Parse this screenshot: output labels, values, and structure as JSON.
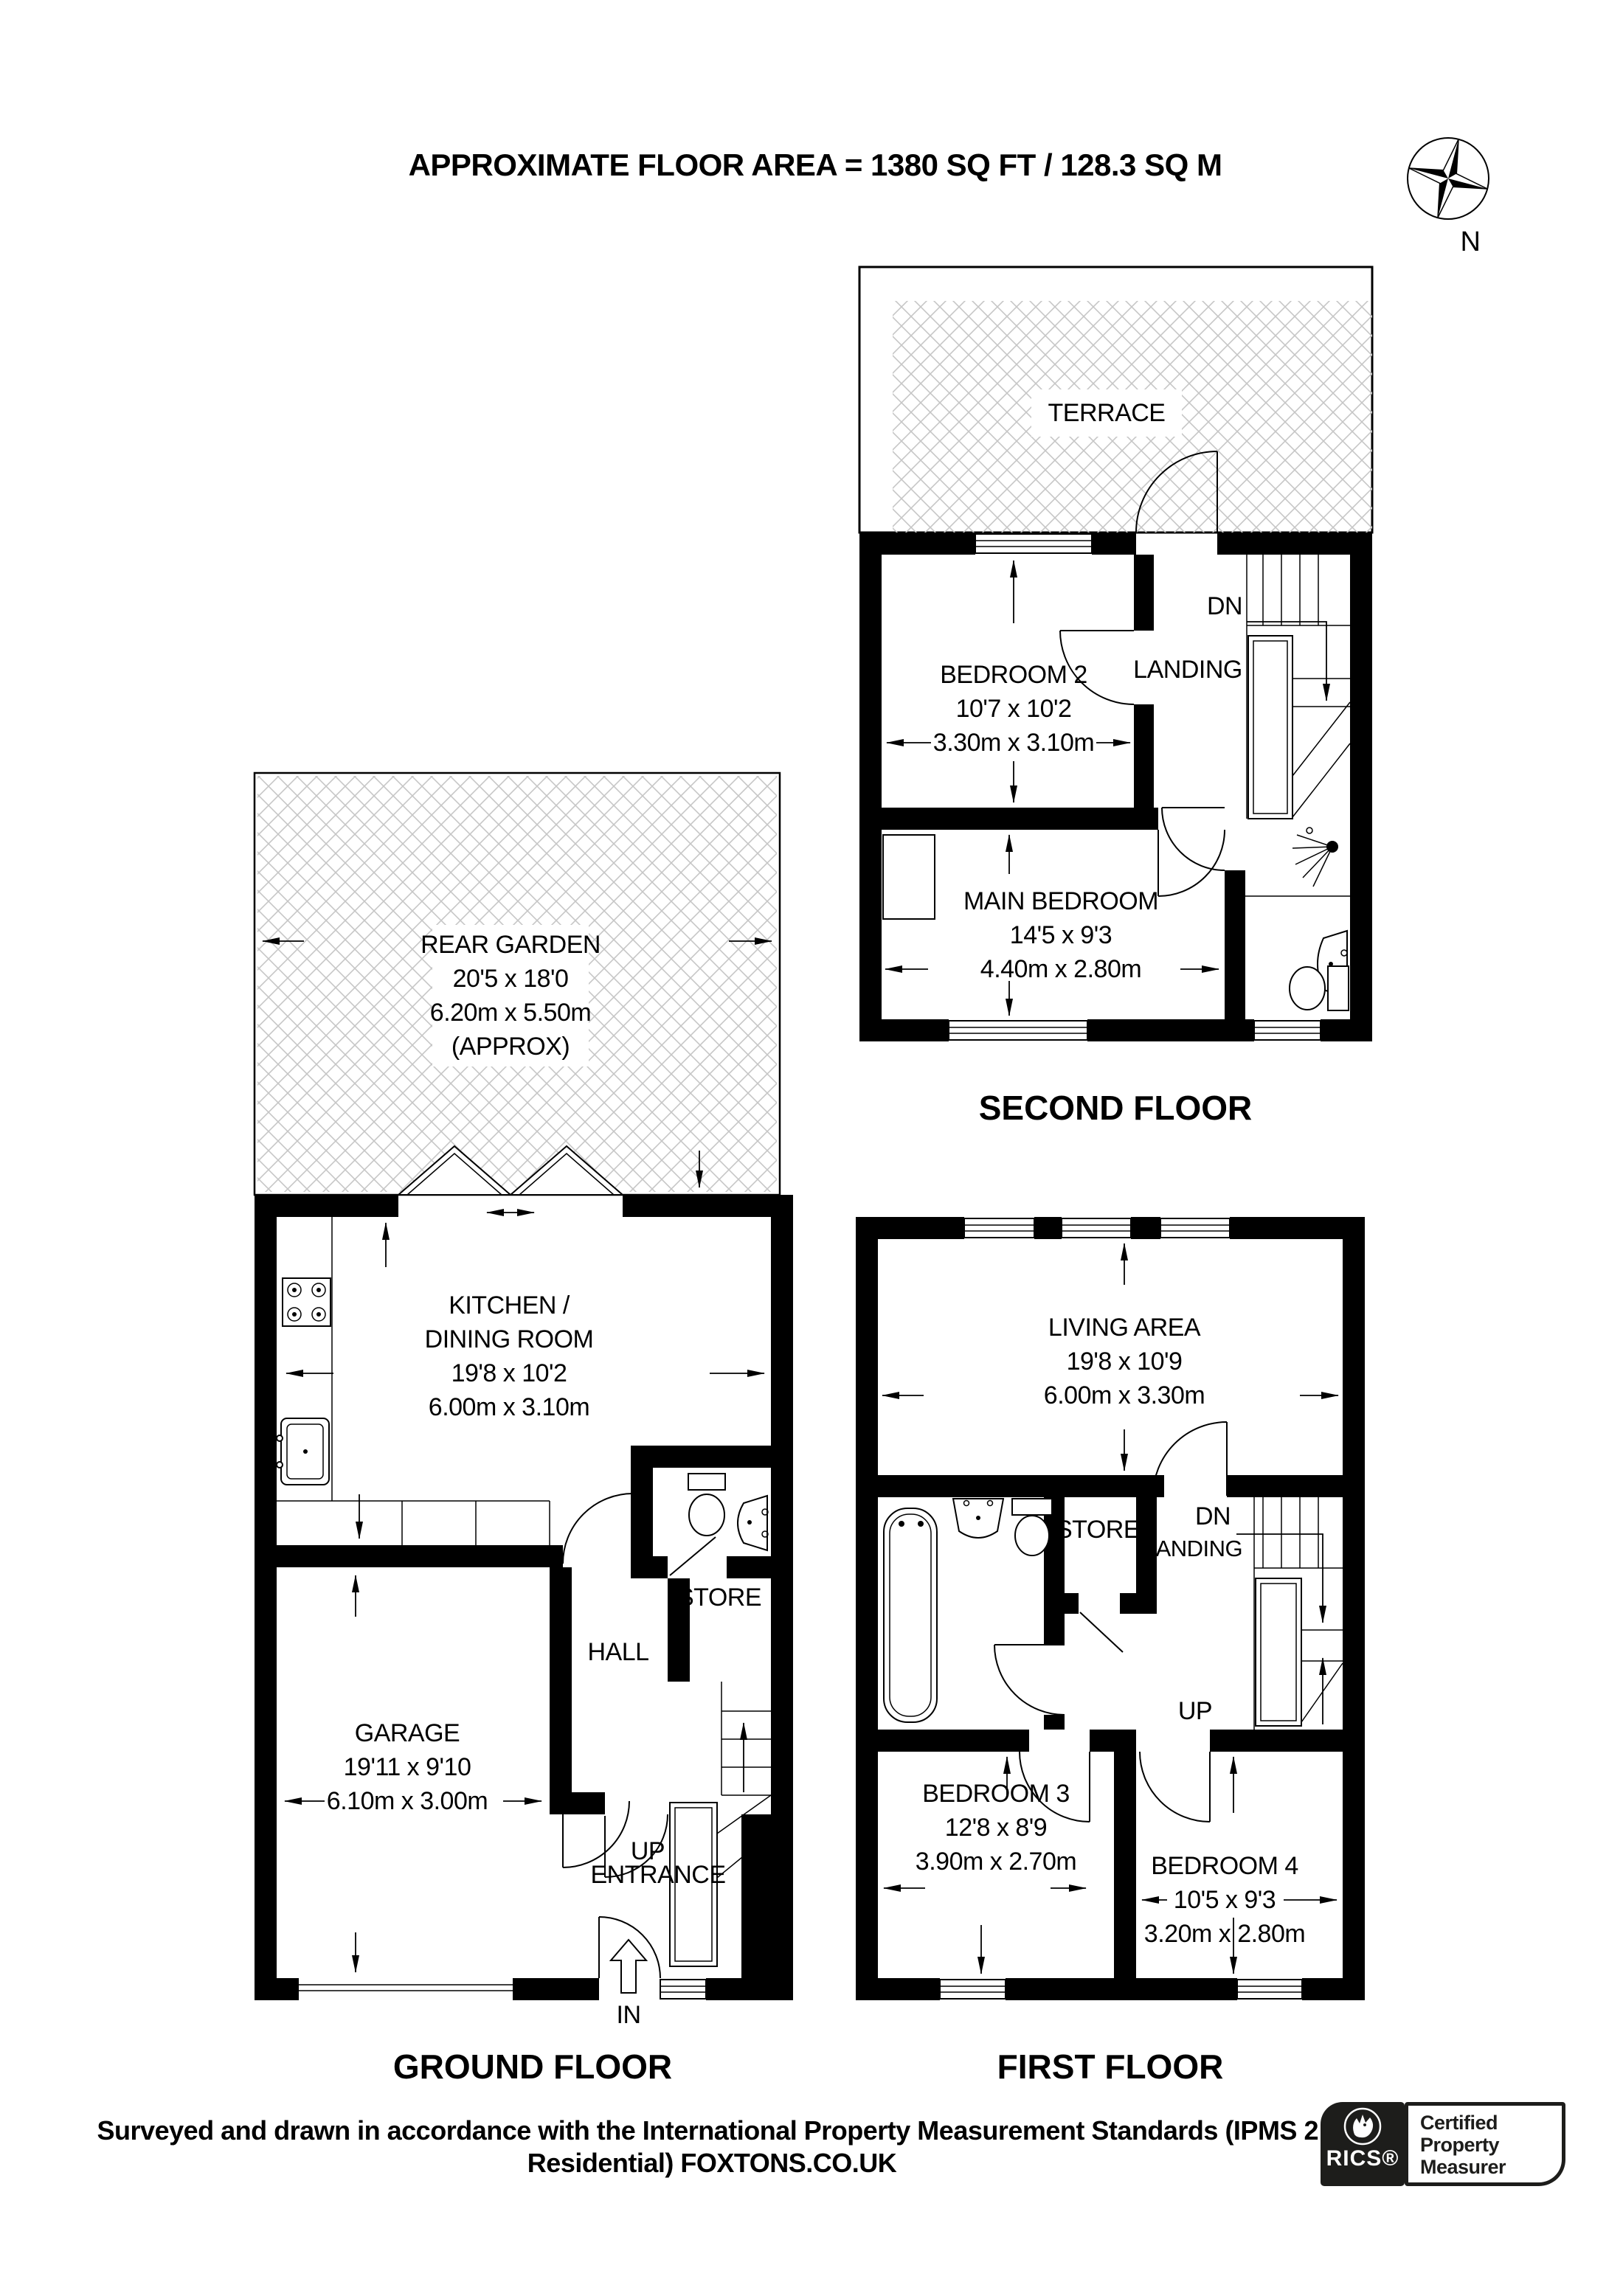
{
  "title": "APPROXIMATE FLOOR AREA = 1380 SQ FT / 128.3 SQ M",
  "compass": {
    "label": "N"
  },
  "floors": {
    "second": {
      "label": "SECOND FLOOR",
      "terrace": {
        "name": "TERRACE"
      },
      "bedroom2": {
        "name": "BEDROOM 2",
        "dim_ft": "10'7 x 10'2",
        "dim_m": "3.30m x 3.10m"
      },
      "landing": "LANDING",
      "dn": "DN",
      "main_bedroom": {
        "name": "MAIN BEDROOM",
        "dim_ft": "14'5 x 9'3",
        "dim_m": "4.40m x 2.80m"
      }
    },
    "ground": {
      "label": "GROUND FLOOR",
      "garden": {
        "name": "REAR GARDEN",
        "dim_ft": "20'5 x 18'0",
        "dim_m": "6.20m x 5.50m",
        "approx": "(APPROX)"
      },
      "kitchen": {
        "name_line1": "KITCHEN /",
        "name_line2": "DINING ROOM",
        "dim_ft": "19'8 x 10'2",
        "dim_m": "6.00m x 3.10m"
      },
      "garage": {
        "name": "GARAGE",
        "dim_ft": "19'11 x 9'10",
        "dim_m": "6.10m x 3.00m"
      },
      "hall": "HALL",
      "store": "STORE",
      "up": "UP",
      "entrance": "ENTRANCE",
      "in": "IN"
    },
    "first": {
      "label": "FIRST FLOOR",
      "living": {
        "name": "LIVING AREA",
        "dim_ft": "19'8 x 10'9",
        "dim_m": "6.00m x 3.30m"
      },
      "store": "STORE",
      "landing": "LANDING",
      "dn": "DN",
      "up": "UP",
      "bedroom3": {
        "name": "BEDROOM 3",
        "dim_ft": "12'8 x 8'9",
        "dim_m": "3.90m x 2.70m"
      },
      "bedroom4": {
        "name": "BEDROOM 4",
        "dim_ft": "10'5 x 9'3",
        "dim_m": "3.20m x 2.80m"
      }
    }
  },
  "footer": {
    "line1": "Surveyed and drawn in accordance with the International Property Measurement Standards (IPMS 2:",
    "line2": "Residential) FOXTONS.CO.UK"
  },
  "badge": {
    "brand": "RICS®",
    "line1": "Certified",
    "line2": "Property",
    "line3": "Measurer"
  },
  "colors": {
    "wall": "#000000",
    "hatch": "#c6c6c6",
    "badge_black": "#1d1d1b"
  }
}
